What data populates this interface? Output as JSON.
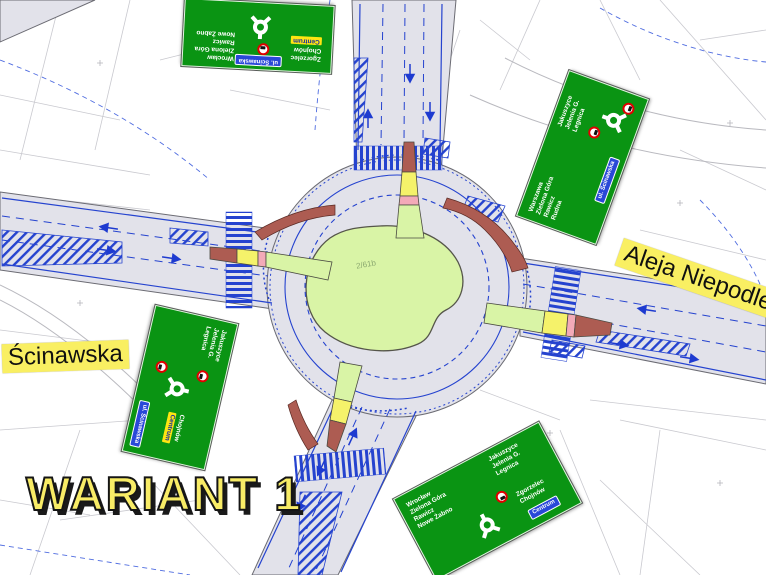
{
  "watermark": {
    "text": "WARIANT 1",
    "color": "#f8ec66"
  },
  "street_labels": {
    "west": "Ścinawska",
    "east": "Aleja Niepodległości"
  },
  "map": {
    "parcel_label": "2/61b",
    "colors": {
      "road_gray": "#e2e2ea",
      "island_green": "#d9f4a6",
      "marking_blue": "#2543cf",
      "island_red": "#ad5c52",
      "island_yellow": "#f5f26a",
      "island_pink": "#f3aab8",
      "sign_green": "#0a9413",
      "label_yellow": "#f9ef62"
    },
    "icons": [
      "roundabout-icon",
      "truck-ban-icon"
    ]
  },
  "signs": {
    "top_left": {
      "col_a": [
        "Zgorzelec",
        "Chojnów"
      ],
      "col_a_highlight": "Centrum",
      "col_b": [
        "Wrocław",
        "Zielona Góra",
        "Rawicz",
        "Nowe Żabno"
      ],
      "plate": "ul. Ścinawska"
    },
    "right": {
      "col_a": [
        "Warszawa",
        "Zielona Góra",
        "Rawicz",
        "Rudna"
      ],
      "col_b": [
        "Jakuszyce",
        "Jelenia G.",
        "Legnica"
      ],
      "plate": "ul. Ścinawska"
    },
    "bottom_left": {
      "col_a": [
        "Jakuszyce",
        "Jelenia G.",
        "Legnica"
      ],
      "col_b": [
        "Chojnów"
      ],
      "col_b_highlight": "Centrum",
      "plate": "ul. Ścinawska"
    },
    "bottom_right": {
      "col_a": [
        "Wrocław",
        "Zielona Góra",
        "Rawicz",
        "Nowe Żabno"
      ],
      "col_b": [
        "Jakuszyce",
        "Jelenia G.",
        "Legnica"
      ],
      "col_c": [
        "Zgorzelec",
        "Chojnów"
      ],
      "plate": "Centrum"
    }
  }
}
